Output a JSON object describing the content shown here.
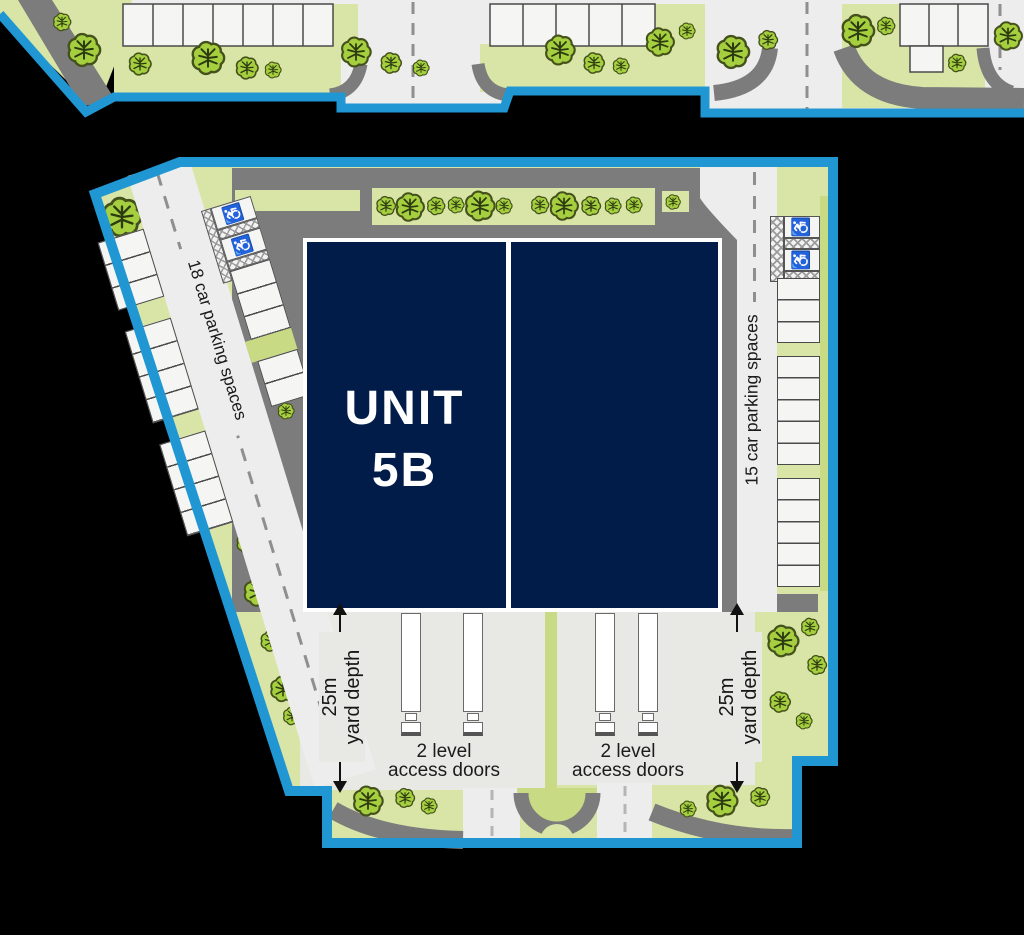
{
  "building": {
    "name_line1": "UNIT",
    "name_line2": "5B"
  },
  "parking": {
    "left_label": "18 car parking spaces",
    "right_label": "15 car parking spaces"
  },
  "yard": {
    "depth_line1": "25m",
    "depth_line2": "yard depth"
  },
  "access": {
    "line1": "2 level",
    "line2": "access doors"
  },
  "icons": {
    "wheelchair": "♿"
  },
  "colors": {
    "boundary": "#2097d3",
    "navy": "#021c49",
    "verge": "#d8e5a6",
    "verge2": "#c9da84",
    "tree": "#a5cf3f",
    "treeline": "#45511c",
    "branch": "#2c3a10",
    "asphalt": "#7c7c7c",
    "road": "#ededed",
    "yard": "#e8e9e4",
    "bay": "#f5f5f3",
    "bayline": "#4a4a4a",
    "ink": "#1a1a1a"
  }
}
